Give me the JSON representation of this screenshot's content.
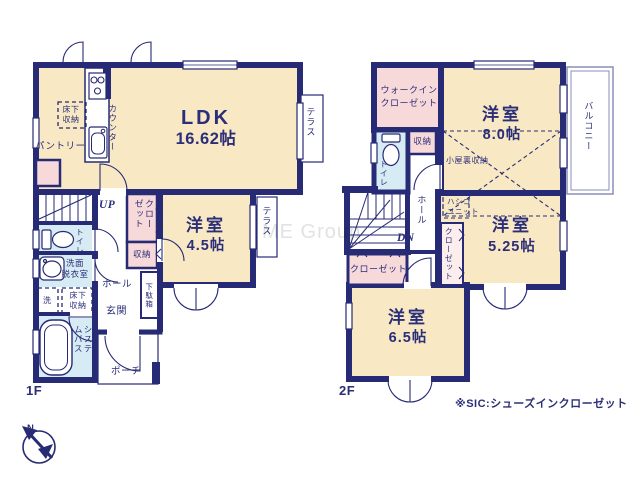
{
  "colors": {
    "wall": "#272a74",
    "room_cream": "#f8e9c4",
    "closet_pink": "#f7d9da",
    "water_blue": "#d6ebf4",
    "text_navy": "#2b2e78",
    "watermark_gray": "#e2e2e2"
  },
  "compass": {
    "north": "N"
  },
  "watermark": "ME Group",
  "note": "※SIC:シューズインクローゼット",
  "floor1": {
    "label": "1F",
    "rooms": {
      "ldk": {
        "name": "LDK",
        "size": "16.62帖"
      },
      "bedroom": {
        "name": "洋室",
        "size": "4.5帖"
      }
    },
    "labels": {
      "underfloor_kitchen": "床下収納",
      "counter": "カウンター",
      "pantry": "パントリー",
      "terrace_ldk": "テラス",
      "terrace_bedroom": "テラス",
      "up": "UP",
      "closet": "クローゼット",
      "storage": "収納",
      "toilet": "トイレ",
      "washroom": "洗面\n脱衣室",
      "laundry": "洗",
      "underfloor_wash": "床下収納",
      "bath": "システムバス",
      "hall": "ホール",
      "entrance": "玄関",
      "shoe_box": "下駄箱",
      "porch": "ポーチ"
    }
  },
  "floor2": {
    "label": "2F",
    "rooms": {
      "bedroom8": {
        "name": "洋室",
        "size": "8.0帖"
      },
      "bedroom525": {
        "name": "洋室",
        "size": "5.25帖"
      },
      "bedroom65": {
        "name": "洋室",
        "size": "6.5帖"
      }
    },
    "labels": {
      "wic": "ウォークインクローゼット",
      "storage": "収納",
      "toilet": "トイレ",
      "attic": "小屋裏収納",
      "ladder": "ハシゴ\nユニット",
      "hall": "ホール",
      "dn": "DN",
      "closet_tall": "クローゼット",
      "closet_wide": "クローゼット",
      "balcony": "バルコニー"
    }
  }
}
